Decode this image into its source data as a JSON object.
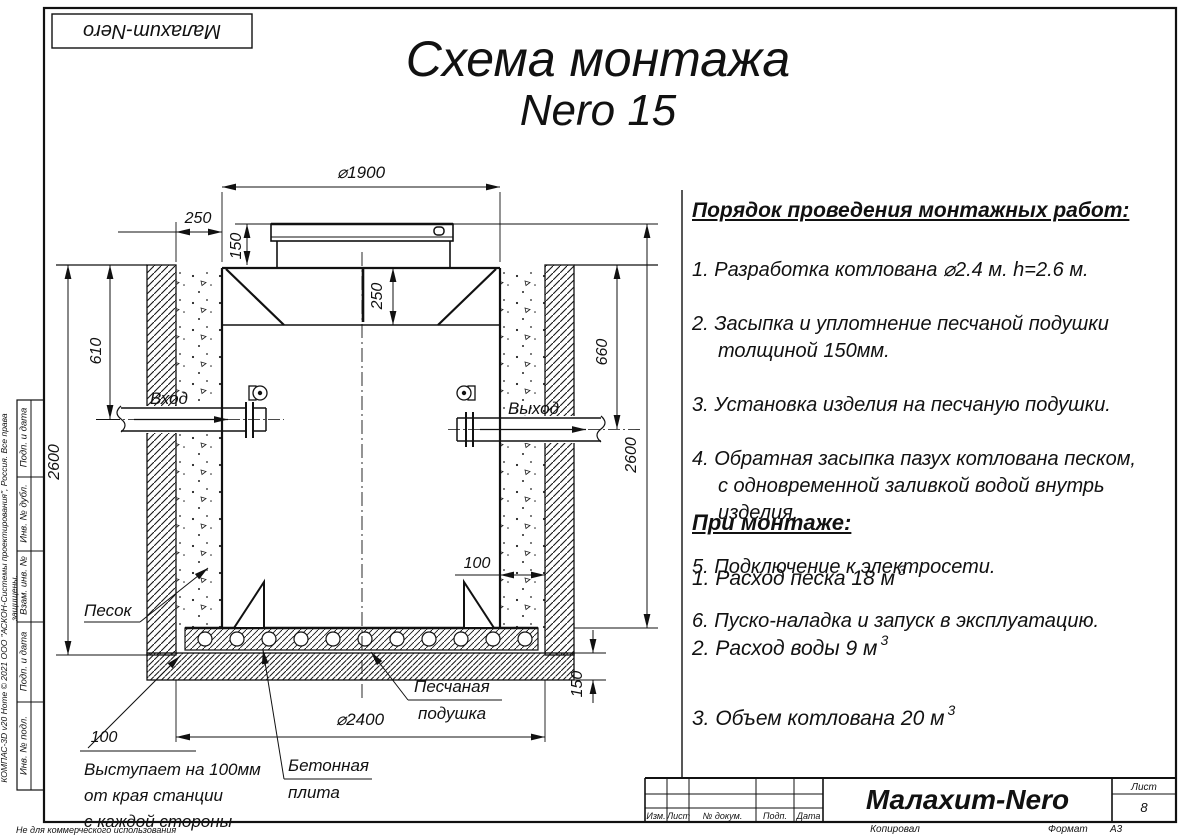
{
  "stamp": {
    "brand": "Малахит-Nero"
  },
  "title": {
    "line1": "Схема монтажа",
    "line2": "Nero 15"
  },
  "instructions": {
    "heading": "Порядок проведения монтажных работ:",
    "items": [
      "1. Разработка котлована ⌀2.4 м. h=2.6 м.",
      "2. Засыпка и уплотнение песчаной подушки\nтолщиной 150мм.",
      "3. Установка изделия на песчаную подушки.",
      "4. Обратная засыпка пазух котлована песком,\nс одновременной заливкой водой внутрь\nизделия.",
      "5. Подключение к электросети.",
      "6. Пуско-наладка и запуск в эксплуатацию."
    ]
  },
  "montage": {
    "heading": "При монтаже:",
    "items": [
      {
        "text": "1. Расход песка 18 м",
        "sup": "3"
      },
      {
        "text": "2. Расход воды 9 м",
        "sup": "3"
      },
      {
        "text": "3. Объем котлована 20 м",
        "sup": "3"
      }
    ]
  },
  "drawing": {
    "dims": {
      "top_diameter": "⌀1900",
      "backfill_left": "250",
      "lid_height": "150",
      "neck_inner": "250",
      "inlet_depth": "610",
      "pit_depth_left": "2600",
      "outlet_depth": "660",
      "pit_depth_right": "2600",
      "backfill_right": "100",
      "slab_overhang": "100",
      "bottom_diameter": "⌀2400",
      "cushion_height": "150"
    },
    "labels": {
      "inlet": "Вход",
      "outlet": "Выход",
      "sand": "Песок",
      "sand_cushion_1": "Песчаная",
      "sand_cushion_2": "подушка",
      "concrete_slab_1": "Бетонная",
      "concrete_slab_2": "плита",
      "overhang_note": "Выступает на 100мм\nот края станции\nс каждой стороны"
    }
  },
  "titleblock": {
    "columns": [
      "Изм.",
      "Лист",
      "№ докум.",
      "Подп.",
      "Дата"
    ],
    "brand": "Малахит-Nero",
    "sheet_label": "Лист",
    "sheet_number": "8",
    "copied_by": "Копировал",
    "format_label": "Формат",
    "format_value": "А3"
  },
  "sidebar": {
    "cells": [
      "Подп. и дата",
      "Инв. № дубл.",
      "Взам. инв. №",
      "Подп. и дата",
      "Инв. № подл."
    ],
    "copyright": "КОМПАС-3D v20 Home © 2021 ООО \"АСКОН-Системы проектирования\", Россия. Все права защищены.",
    "footer": "Не для коммерческого использования"
  }
}
